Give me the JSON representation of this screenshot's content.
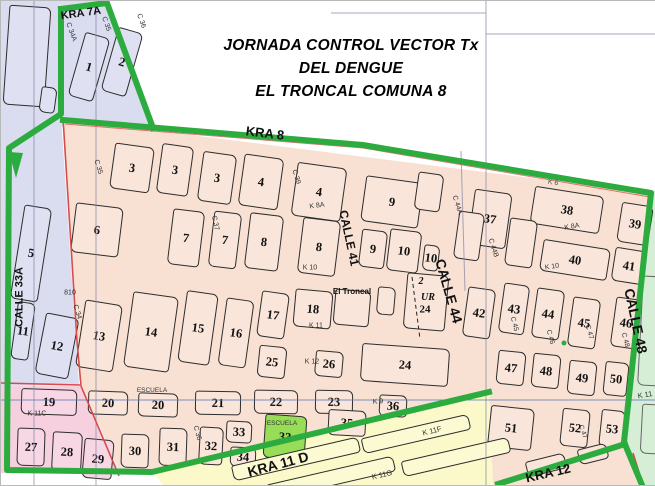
{
  "title": {
    "line1": "JORNADA CONTROL VECTOR Tx",
    "line2": "DEL DENGUE",
    "line3": "EL TRONCAL COMUNA 8"
  },
  "colors": {
    "peach": "#f8e1d3",
    "peach_block": "#f9e5d9",
    "lavender": "#dadcef",
    "lavender_block": "#dfe1f3",
    "rose": "#f6d0de",
    "rose_block": "#f8d7e4",
    "yellow": "#fbf9c9",
    "yellow_block": "#fcfad2",
    "mint": "#d6eed6",
    "school": "#97dd57",
    "border_green": "#2cab3f",
    "red": "#d84b4b",
    "grid": "#8a8aa8",
    "grid_blue": "#5d79b8",
    "outline": "#2d2d2d"
  },
  "blocks": [
    {
      "label": "1",
      "x": 88,
      "y": 66,
      "w": 26,
      "h": 66,
      "r": 16,
      "zone": "lavender"
    },
    {
      "label": "2",
      "x": 121,
      "y": 61,
      "w": 26,
      "h": 66,
      "r": 16,
      "zone": "lavender"
    },
    {
      "label": "",
      "x": 26,
      "y": 55,
      "w": 42,
      "h": 100,
      "r": 4,
      "zone": "lavender"
    },
    {
      "label": "",
      "x": 47,
      "y": 99,
      "w": 16,
      "h": 26,
      "r": 8,
      "zone": "lavender"
    },
    {
      "label": "5",
      "x": 30,
      "y": 252,
      "w": 28,
      "h": 95,
      "r": 9,
      "zone": "lavender"
    },
    {
      "label": "11",
      "x": 22,
      "y": 330,
      "w": 18,
      "h": 58,
      "r": 8,
      "zone": "lavender"
    },
    {
      "label": "12",
      "x": 56,
      "y": 345,
      "w": 34,
      "h": 62,
      "r": 11,
      "zone": "lavender"
    },
    {
      "label": "19",
      "x": 48,
      "y": 401,
      "w": 56,
      "h": 26,
      "r": 2,
      "zone": "rose"
    },
    {
      "label": "27",
      "x": 30,
      "y": 446,
      "w": 28,
      "h": 38,
      "r": 2,
      "zone": "rose"
    },
    {
      "label": "28",
      "x": 66,
      "y": 451,
      "w": 30,
      "h": 40,
      "r": 3,
      "zone": "rose"
    },
    {
      "label": "29",
      "x": 97,
      "y": 458,
      "w": 30,
      "h": 40,
      "r": 5,
      "zone": "rose"
    },
    {
      "label": "3",
      "x": 131,
      "y": 167,
      "w": 40,
      "h": 46,
      "r": 8,
      "zone": "peach"
    },
    {
      "label": "3",
      "x": 174,
      "y": 169,
      "w": 32,
      "h": 50,
      "r": 8,
      "zone": "peach"
    },
    {
      "label": "3",
      "x": 216,
      "y": 177,
      "w": 34,
      "h": 50,
      "r": 8,
      "zone": "peach"
    },
    {
      "label": "4",
      "x": 260,
      "y": 181,
      "w": 40,
      "h": 52,
      "r": 8,
      "zone": "peach"
    },
    {
      "label": "4",
      "x": 318,
      "y": 191,
      "w": 50,
      "h": 54,
      "r": 8,
      "zone": "peach"
    },
    {
      "label": "9",
      "x": 391,
      "y": 201,
      "w": 58,
      "h": 46,
      "r": 8,
      "zone": "peach"
    },
    {
      "label": "",
      "x": 428,
      "y": 191,
      "w": 26,
      "h": 38,
      "r": 8,
      "zone": "peach"
    },
    {
      "label": "37",
      "x": 489,
      "y": 218,
      "w": 38,
      "h": 56,
      "r": 8,
      "zone": "peach"
    },
    {
      "label": "38",
      "x": 566,
      "y": 209,
      "w": 70,
      "h": 38,
      "r": 9,
      "zone": "peach"
    },
    {
      "label": "39",
      "x": 634,
      "y": 223,
      "w": 32,
      "h": 40,
      "r": 9,
      "zone": "peach"
    },
    {
      "label": "6",
      "x": 96,
      "y": 229,
      "w": 48,
      "h": 50,
      "r": 7,
      "zone": "peach"
    },
    {
      "label": "7",
      "x": 185,
      "y": 237,
      "w": 32,
      "h": 56,
      "r": 7,
      "zone": "peach"
    },
    {
      "label": "7",
      "x": 224,
      "y": 239,
      "w": 28,
      "h": 56,
      "r": 7,
      "zone": "peach"
    },
    {
      "label": "8",
      "x": 263,
      "y": 241,
      "w": 34,
      "h": 56,
      "r": 7,
      "zone": "peach"
    },
    {
      "label": "8",
      "x": 318,
      "y": 246,
      "w": 38,
      "h": 56,
      "r": 7,
      "zone": "peach"
    },
    {
      "label": "9",
      "x": 372,
      "y": 248,
      "w": 26,
      "h": 38,
      "r": 7,
      "zone": "peach"
    },
    {
      "label": "10",
      "x": 403,
      "y": 250,
      "w": 32,
      "h": 42,
      "r": 7,
      "zone": "peach"
    },
    {
      "label": "10",
      "x": 430,
      "y": 257,
      "w": 16,
      "h": 26,
      "r": 7,
      "zone": "peach"
    },
    {
      "label": "",
      "x": 468,
      "y": 235,
      "w": 26,
      "h": 48,
      "r": 8,
      "zone": "peach"
    },
    {
      "label": "",
      "x": 520,
      "y": 242,
      "w": 28,
      "h": 48,
      "r": 8,
      "zone": "peach"
    },
    {
      "label": "40",
      "x": 574,
      "y": 259,
      "w": 68,
      "h": 32,
      "r": 9,
      "zone": "peach"
    },
    {
      "label": "41",
      "x": 628,
      "y": 265,
      "w": 32,
      "h": 34,
      "r": 9,
      "zone": "peach"
    },
    {
      "label": "13",
      "x": 98,
      "y": 335,
      "w": 38,
      "h": 68,
      "r": 9,
      "zone": "peach"
    },
    {
      "label": "14",
      "x": 150,
      "y": 331,
      "w": 46,
      "h": 76,
      "r": 8,
      "zone": "peach"
    },
    {
      "label": "15",
      "x": 197,
      "y": 327,
      "w": 32,
      "h": 72,
      "r": 8,
      "zone": "peach"
    },
    {
      "label": "16",
      "x": 235,
      "y": 332,
      "w": 28,
      "h": 68,
      "r": 8,
      "zone": "peach"
    },
    {
      "label": "17",
      "x": 272,
      "y": 314,
      "w": 28,
      "h": 46,
      "r": 8,
      "zone": "peach"
    },
    {
      "label": "25",
      "x": 271,
      "y": 361,
      "w": 28,
      "h": 32,
      "r": 6,
      "zone": "peach"
    },
    {
      "label": "18",
      "x": 312,
      "y": 308,
      "w": 38,
      "h": 38,
      "r": 5,
      "zone": "peach"
    },
    {
      "label": "",
      "x": 351,
      "y": 307,
      "w": 36,
      "h": 36,
      "r": 5,
      "zone": "peach"
    },
    {
      "label": "",
      "x": 385,
      "y": 300,
      "w": 18,
      "h": 28,
      "r": 5,
      "zone": "peach"
    },
    {
      "label": "",
      "x": 425,
      "y": 301,
      "w": 42,
      "h": 56,
      "r": 5,
      "zone": "peach"
    },
    {
      "label": "24",
      "x": 404,
      "y": 364,
      "w": 88,
      "h": 38,
      "r": 4,
      "zone": "peach"
    },
    {
      "label": "26",
      "x": 328,
      "y": 363,
      "w": 28,
      "h": 26,
      "r": 5,
      "zone": "peach"
    },
    {
      "label": "42",
      "x": 478,
      "y": 312,
      "w": 28,
      "h": 50,
      "r": 8,
      "zone": "peach"
    },
    {
      "label": "43",
      "x": 513,
      "y": 308,
      "w": 26,
      "h": 50,
      "r": 8,
      "zone": "peach"
    },
    {
      "label": "44",
      "x": 547,
      "y": 313,
      "w": 28,
      "h": 50,
      "r": 8,
      "zone": "peach"
    },
    {
      "label": "45",
      "x": 583,
      "y": 322,
      "w": 28,
      "h": 50,
      "r": 8,
      "zone": "peach"
    },
    {
      "label": "46",
      "x": 625,
      "y": 322,
      "w": 26,
      "h": 50,
      "r": 8,
      "zone": "peach"
    },
    {
      "label": "47",
      "x": 510,
      "y": 367,
      "w": 28,
      "h": 34,
      "r": 6,
      "zone": "peach"
    },
    {
      "label": "48",
      "x": 545,
      "y": 370,
      "w": 28,
      "h": 34,
      "r": 6,
      "zone": "peach"
    },
    {
      "label": "49",
      "x": 581,
      "y": 377,
      "w": 28,
      "h": 34,
      "r": 6,
      "zone": "peach"
    },
    {
      "label": "50",
      "x": 615,
      "y": 378,
      "w": 24,
      "h": 34,
      "r": 6,
      "zone": "peach"
    },
    {
      "label": "51",
      "x": 510,
      "y": 427,
      "w": 44,
      "h": 42,
      "r": 6,
      "zone": "peach"
    },
    {
      "label": "52",
      "x": 574,
      "y": 427,
      "w": 28,
      "h": 38,
      "r": 6,
      "zone": "peach"
    },
    {
      "label": "53",
      "x": 611,
      "y": 428,
      "w": 24,
      "h": 38,
      "r": 6,
      "zone": "peach"
    },
    {
      "label": "20",
      "x": 107,
      "y": 402,
      "w": 40,
      "h": 24,
      "r": 2,
      "zone": "peach"
    },
    {
      "label": "20",
      "x": 157,
      "y": 404,
      "w": 40,
      "h": 24,
      "r": 2,
      "zone": "peach"
    },
    {
      "label": "21",
      "x": 217,
      "y": 402,
      "w": 46,
      "h": 24,
      "r": 1,
      "zone": "peach"
    },
    {
      "label": "22",
      "x": 275,
      "y": 401,
      "w": 44,
      "h": 24,
      "r": 1,
      "zone": "peach"
    },
    {
      "label": "23",
      "x": 333,
      "y": 401,
      "w": 38,
      "h": 24,
      "r": 1,
      "zone": "peach"
    },
    {
      "label": "35",
      "x": 346,
      "y": 422,
      "w": 38,
      "h": 26,
      "r": 3,
      "zone": "peach"
    },
    {
      "label": "36",
      "x": 392,
      "y": 405,
      "w": 28,
      "h": 22,
      "r": 3,
      "zone": "peach"
    },
    {
      "label": "30",
      "x": 134,
      "y": 450,
      "w": 28,
      "h": 34,
      "r": 2,
      "zone": "peach"
    },
    {
      "label": "31",
      "x": 172,
      "y": 446,
      "w": 28,
      "h": 38,
      "r": 2,
      "zone": "peach"
    },
    {
      "label": "32",
      "x": 210,
      "y": 445,
      "w": 24,
      "h": 38,
      "r": 3,
      "zone": "peach"
    },
    {
      "label": "33",
      "x": 238,
      "y": 431,
      "w": 26,
      "h": 22,
      "r": 3,
      "zone": "peach"
    },
    {
      "label": "34",
      "x": 242,
      "y": 456,
      "w": 26,
      "h": 20,
      "r": 3,
      "zone": "peach"
    },
    {
      "label": "33",
      "x": 284,
      "y": 436,
      "w": 42,
      "h": 44,
      "r": 4,
      "zone": "school"
    },
    {
      "label": "",
      "x": 295,
      "y": 458,
      "w": 130,
      "h": 16,
      "r": -13,
      "zone": "yellowp"
    },
    {
      "label": "",
      "x": 330,
      "y": 477,
      "w": 130,
      "h": 16,
      "r": -13,
      "zone": "yellowp"
    },
    {
      "label": "",
      "x": 415,
      "y": 433,
      "w": 110,
      "h": 16,
      "r": -13,
      "zone": "yellowp"
    },
    {
      "label": "",
      "x": 455,
      "y": 456,
      "w": 110,
      "h": 16,
      "r": -13,
      "zone": "yellowp"
    },
    {
      "label": "",
      "x": 545,
      "y": 464,
      "w": 40,
      "h": 16,
      "r": -14,
      "zone": "peach"
    },
    {
      "label": "",
      "x": 592,
      "y": 453,
      "w": 30,
      "h": 16,
      "r": -14,
      "zone": "peach"
    },
    {
      "label": "",
      "x": 650,
      "y": 330,
      "w": 22,
      "h": 110,
      "r": 3,
      "zone": "mintp"
    },
    {
      "label": "",
      "x": 649,
      "y": 428,
      "w": 18,
      "h": 50,
      "r": 3,
      "zone": "mintp"
    }
  ],
  "street_labels": [
    {
      "t": "KRA 7A",
      "x": 80,
      "y": 13,
      "r": -8,
      "s": 11,
      "b": 1
    },
    {
      "t": "C 34A",
      "x": 70,
      "y": 31,
      "r": 70,
      "s": 7
    },
    {
      "t": "C 35",
      "x": 105,
      "y": 23,
      "r": 70,
      "s": 7
    },
    {
      "t": "C 36",
      "x": 140,
      "y": 20,
      "r": 70,
      "s": 7
    },
    {
      "t": "KRA 8",
      "x": 264,
      "y": 132,
      "r": 7,
      "s": 13,
      "b": 1
    },
    {
      "t": "C 35",
      "x": 97,
      "y": 166,
      "r": 72,
      "s": 7
    },
    {
      "t": "C 37",
      "x": 214,
      "y": 222,
      "r": 78,
      "s": 7
    },
    {
      "t": "C 39",
      "x": 295,
      "y": 176,
      "r": 72,
      "s": 7
    },
    {
      "t": "K 8A",
      "x": 316,
      "y": 205,
      "r": -8,
      "s": 7
    },
    {
      "t": "CALLE 41",
      "x": 348,
      "y": 237,
      "r": 78,
      "s": 12,
      "b": 1
    },
    {
      "t": "C 44A",
      "x": 456,
      "y": 204,
      "r": 72,
      "s": 7
    },
    {
      "t": "C 44B",
      "x": 492,
      "y": 247,
      "r": 72,
      "s": 7
    },
    {
      "t": "K 8A",
      "x": 571,
      "y": 226,
      "r": -10,
      "s": 7
    },
    {
      "t": "K 6",
      "x": 552,
      "y": 182,
      "r": 8,
      "s": 7,
      "col": "#555"
    },
    {
      "t": "K 10",
      "x": 309,
      "y": 267,
      "r": 0,
      "s": 7
    },
    {
      "t": "K 10",
      "x": 551,
      "y": 266,
      "r": -8,
      "s": 7
    },
    {
      "t": "CALLE 44",
      "x": 448,
      "y": 290,
      "r": 74,
      "s": 14,
      "b": 1
    },
    {
      "t": "CALLE 48",
      "x": 635,
      "y": 320,
      "r": 78,
      "s": 14,
      "b": 1
    },
    {
      "t": "El Troncal",
      "x": 351,
      "y": 291,
      "r": 0,
      "s": 8,
      "b": 1
    },
    {
      "t": "K 11",
      "x": 315,
      "y": 325,
      "r": 0,
      "s": 7
    },
    {
      "t": "810",
      "x": 69,
      "y": 292,
      "r": 0,
      "s": 7
    },
    {
      "t": "C 34",
      "x": 76,
      "y": 311,
      "r": 72,
      "s": 7
    },
    {
      "t": "CALLE 33A",
      "x": 19,
      "y": 296,
      "r": -90,
      "s": 11,
      "b": 1
    },
    {
      "t": "K 11C",
      "x": 36,
      "y": 413,
      "r": 0,
      "s": 7
    },
    {
      "t": "ESCUELA",
      "x": 151,
      "y": 390,
      "r": 0,
      "s": 6.5
    },
    {
      "t": "K 12",
      "x": 311,
      "y": 361,
      "r": 0,
      "s": 7
    },
    {
      "t": "K 9",
      "x": 377,
      "y": 401,
      "r": -4,
      "s": 7
    },
    {
      "t": "K 11F",
      "x": 431,
      "y": 430,
      "r": -14,
      "s": 7.5
    },
    {
      "t": "K 11G",
      "x": 381,
      "y": 474,
      "r": -13,
      "s": 7.5
    },
    {
      "t": "KRA 11 D",
      "x": 277,
      "y": 463,
      "r": -15,
      "s": 14,
      "b": 1
    },
    {
      "t": "KRA  12",
      "x": 547,
      "y": 472,
      "r": -13,
      "s": 13,
      "b": 1
    },
    {
      "t": "K 11",
      "x": 644,
      "y": 394,
      "r": -10,
      "s": 7.5
    },
    {
      "t": "C 36",
      "x": 196,
      "y": 432,
      "r": 75,
      "s": 7
    },
    {
      "t": "C 45",
      "x": 513,
      "y": 323,
      "r": 75,
      "s": 7
    },
    {
      "t": "C 46",
      "x": 549,
      "y": 336,
      "r": 75,
      "s": 7
    },
    {
      "t": "C 47",
      "x": 588,
      "y": 331,
      "r": 75,
      "s": 7
    },
    {
      "t": "C 48",
      "x": 624,
      "y": 339,
      "r": 75,
      "s": 7
    },
    {
      "t": "C 47",
      "x": 581,
      "y": 431,
      "r": 70,
      "s": 6.5
    },
    {
      "t": "ESCUELA",
      "x": 281,
      "y": 423,
      "r": 0,
      "s": 6.5
    },
    {
      "t": "2",
      "x": 420,
      "y": 281,
      "r": 0,
      "s": 10,
      "b": 1,
      "it": 1,
      "f": 1
    },
    {
      "t": "UR",
      "x": 427,
      "y": 297,
      "r": 0,
      "s": 10,
      "b": 1,
      "it": 1,
      "f": 1
    },
    {
      "t": "24",
      "x": 424,
      "y": 309,
      "r": 0,
      "s": 11,
      "b": 1,
      "f": 1
    }
  ]
}
